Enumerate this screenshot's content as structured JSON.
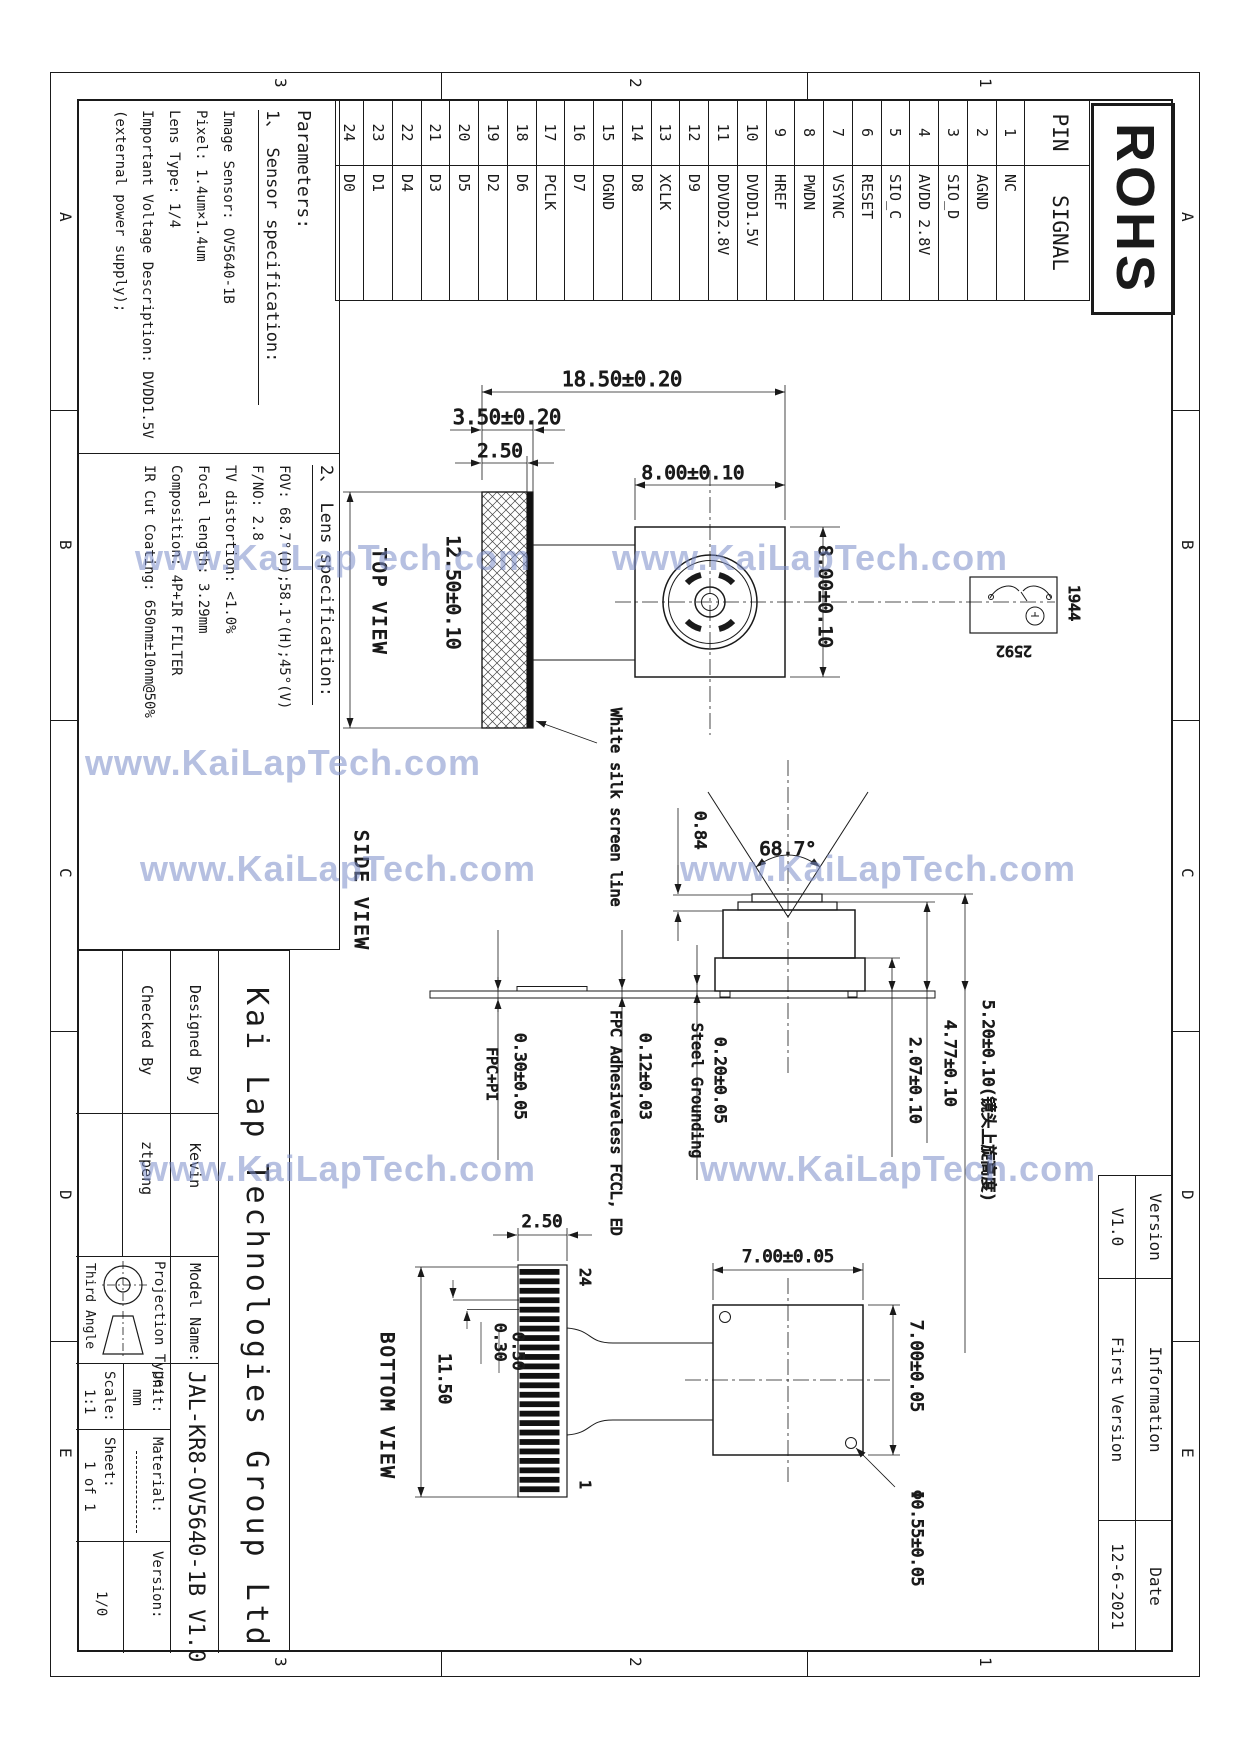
{
  "sheet": {
    "rohs": "ROHS",
    "watermark": "www.KaiLapTech.com",
    "zone_cols": [
      "1",
      "2",
      "3"
    ],
    "zone_rows": [
      "A",
      "B",
      "C",
      "D",
      "E"
    ]
  },
  "pin_table": {
    "headers": [
      "PIN",
      "SIGNAL"
    ],
    "rows": [
      [
        "1",
        "NC"
      ],
      [
        "2",
        "AGND"
      ],
      [
        "3",
        "SIO_D"
      ],
      [
        "4",
        "AVDD 2.8V"
      ],
      [
        "5",
        "SIO_C"
      ],
      [
        "6",
        "RESET"
      ],
      [
        "7",
        "VSYNC"
      ],
      [
        "8",
        "PWDN"
      ],
      [
        "9",
        "HREF"
      ],
      [
        "10",
        "DVDD1.5V"
      ],
      [
        "11",
        "DDVDD2.8V"
      ],
      [
        "12",
        "D9"
      ],
      [
        "13",
        "XCLK"
      ],
      [
        "14",
        "D8"
      ],
      [
        "15",
        "DGND"
      ],
      [
        "16",
        "D7"
      ],
      [
        "17",
        "PCLK"
      ],
      [
        "18",
        "D6"
      ],
      [
        "19",
        "D2"
      ],
      [
        "20",
        "D5"
      ],
      [
        "21",
        "D3"
      ],
      [
        "22",
        "D4"
      ],
      [
        "23",
        "D1"
      ],
      [
        "24",
        "D0"
      ]
    ]
  },
  "parameters": {
    "title": "Parameters:",
    "sensor_heading": "1、 Sensor specification:",
    "sensor_lines": [
      "Image Sensor: OV5640-1B",
      "Pixel: 1.4um×1.4um",
      "Lens Type: 1/4",
      "Important Voltage Description: DVDD1.5V",
      "(external power supply);"
    ],
    "lens_heading": "2、 Lens specification:",
    "lens_lines": [
      "FOV: 68.7°(D);58.1°(H);45°(V)",
      "F/NO: 2.8",
      "TV distortion: <1.0%",
      "Focal length: 3.29mm",
      "Composition: 4P+IR FILTER",
      "IR Cut Coating: 650nm±10nm@50%"
    ]
  },
  "views": {
    "top": {
      "label": "TOP VIEW",
      "dim_total": "18.50±0.20",
      "dim_silk": "3.50±0.20",
      "dim_silk_edge": "2.50",
      "dim_head_w": "8.00±0.10",
      "dim_head_h": "8.00±0.10",
      "dim_strip": "12.50±0.10",
      "silk_note": "White silk screen line",
      "sensor_h": "1944",
      "sensor_w": "2592"
    },
    "side": {
      "label": "SIDE VIEW",
      "dim_step": "0.84",
      "dim_fov": "68.7°",
      "dim_body": "2.07±0.10",
      "dim_mid": "4.77±0.10",
      "dim_total": "5.20±0.10(镜头上旋高度)",
      "dim_fpc": "0.30±0.05",
      "fpc_label": "FPC+PI",
      "dim_adh": "0.12±0.03",
      "adh_label": "FPC Adhesiveless FCCL, ED",
      "dim_steel": "0.20±0.05",
      "steel_label": "Steel Grounding"
    },
    "bottom": {
      "label": "BOTTOM VIEW",
      "dim_strip_w": "2.50",
      "dim_finger": "0.30",
      "dim_pitch": "0.50",
      "dim_length": "11.50",
      "dim_body_w": "7.00±0.05",
      "dim_body_h": "7.00±0.05",
      "dim_hole": "Φ0.55±0.05",
      "pin_first": "24",
      "pin_last": "1"
    }
  },
  "title_block": {
    "company": "Kai Lap Technologies Group Ltd",
    "designed_label": "Designed By",
    "designed": "Kevin",
    "checked_label": "Checked By",
    "checked": "ztpeng",
    "model_label": "Model Name:",
    "model": "JAL-KR8-OV5640-1B V1.0",
    "projection_label": "Projection Type:",
    "projection": "Third Angle",
    "unit_label": "Unit:",
    "unit": "mm",
    "scale_label": "Scale:",
    "scale": "1:1",
    "material_label": "Material:",
    "sheet_label": "Sheet:",
    "sheet": "1 of 1",
    "version_label": "Version:",
    "version": "1/0"
  },
  "revision_table": {
    "headers": [
      "Version",
      "Information",
      "Date"
    ],
    "values": [
      "V1.0",
      "First Version",
      "12-6-2021"
    ]
  }
}
